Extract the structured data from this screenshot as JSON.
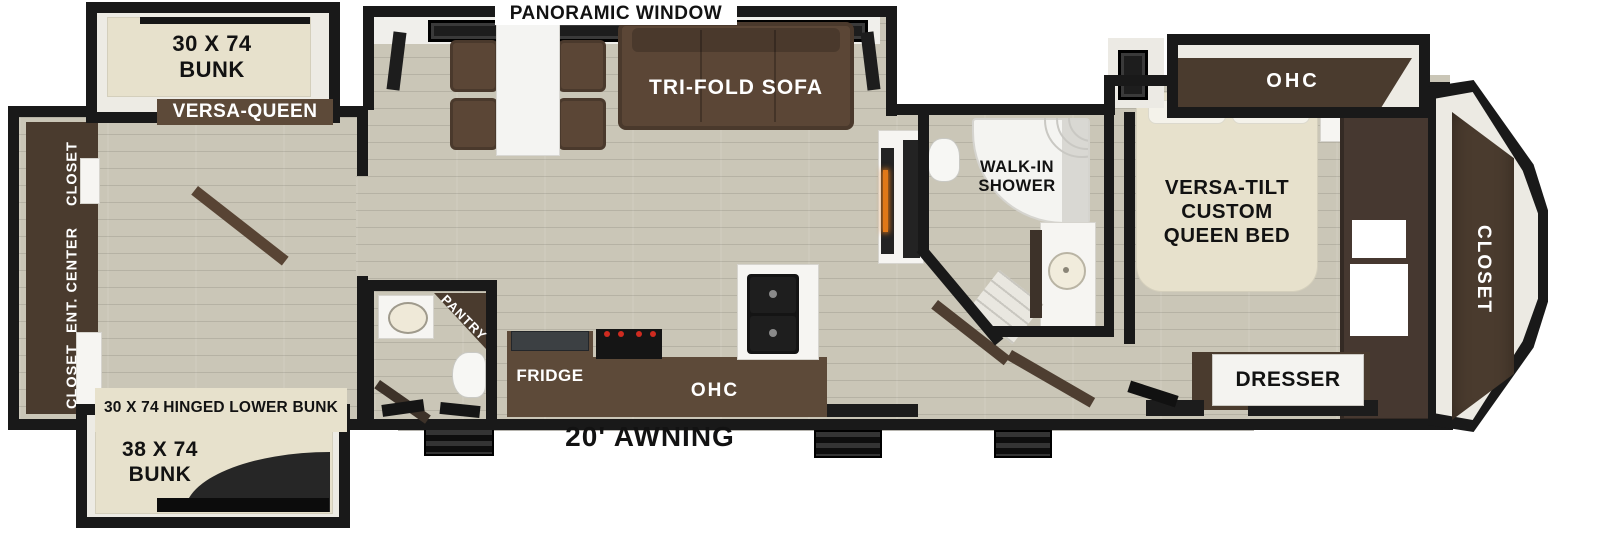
{
  "floorplan": {
    "exterior": {
      "awning_label": "20' AWNING"
    },
    "living_area": {
      "panoramic_window_label": "PANORAMIC WINDOW",
      "sofa_label": "TRI-FOLD SOFA"
    },
    "kitchen": {
      "fridge_label": "FRIDGE",
      "overhead_cabinet_label": "OHC",
      "pantry_label": "PANTRY"
    },
    "bathroom": {
      "shower_label_lines": [
        "WALK-IN",
        "SHOWER"
      ]
    },
    "front_bedroom": {
      "overhead_cabinet_label": "OHC",
      "bed_label_lines": [
        "VERSA-TILT",
        "CUSTOM",
        "QUEEN BED"
      ],
      "dresser_label": "DRESSER",
      "closet_label": "CLOSET"
    },
    "rear_bedroom": {
      "upper_bunk_label_lines": [
        "30 X 74",
        "BUNK"
      ],
      "versa_queen_label": "VERSA-QUEEN",
      "hinged_lower_bunk_label": "30 X 74 HINGED LOWER BUNK",
      "lower_bunk_label_lines": [
        "38 X 74",
        "BUNK"
      ],
      "rear_wall_unit_labels": [
        "CLOSET",
        "ENT. CENTER",
        "CLOSET"
      ]
    }
  },
  "colors": {
    "wall": "#191919",
    "floor": "#cac6b7",
    "slide_interior": "#edebe4",
    "mattress": "#e7e1cc",
    "cabinet_dark": "#4a3b2e",
    "cabinet_mid": "#5d4a39",
    "sofa": "#5b4636",
    "fixture_white": "#f6f5f2",
    "fireplace_glow": "#e07818",
    "burner_red": "#cf2b20",
    "label_dark": "#121212",
    "label_light": "#ffffff"
  }
}
